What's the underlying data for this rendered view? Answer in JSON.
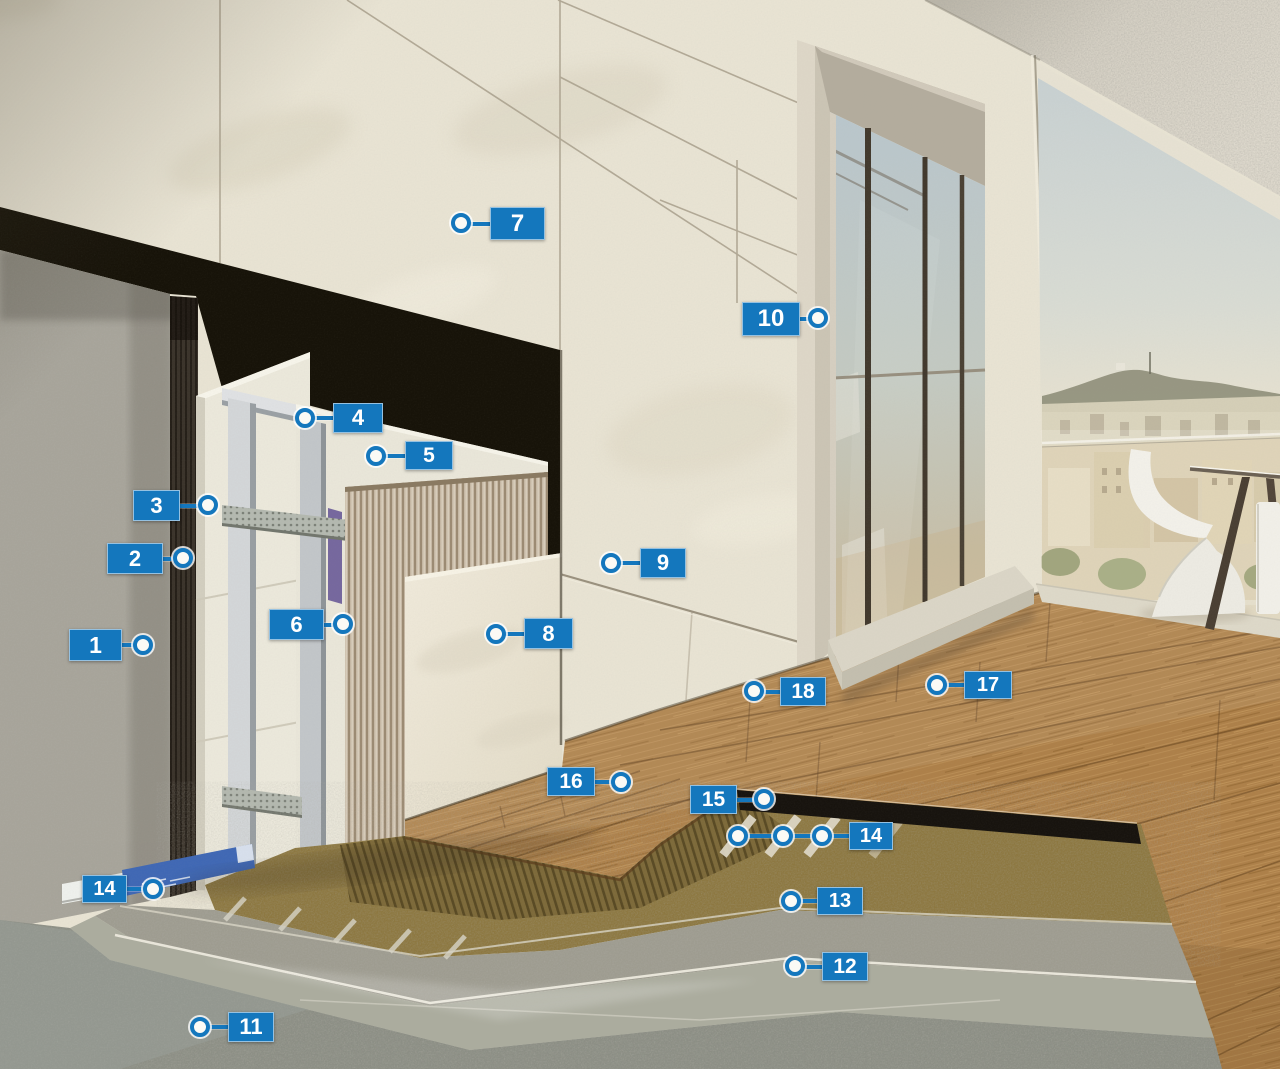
{
  "figure": {
    "type": "construction-cutaway-callout-diagram",
    "accent_color": "#1477bd",
    "marker_text_color": "#ffffff"
  },
  "markers": [
    {
      "id": "m1",
      "label": "1",
      "box": {
        "x": 69,
        "y": 629,
        "w": 53,
        "h": 32
      },
      "side": "right",
      "dots": [
        {
          "x": 143,
          "y": 645
        }
      ]
    },
    {
      "id": "m2",
      "label": "2",
      "box": {
        "x": 107,
        "y": 543,
        "w": 56,
        "h": 31
      },
      "side": "right",
      "dots": [
        {
          "x": 183,
          "y": 558
        }
      ]
    },
    {
      "id": "m3",
      "label": "3",
      "box": {
        "x": 133,
        "y": 490,
        "w": 47,
        "h": 31
      },
      "side": "right",
      "dots": [
        {
          "x": 208,
          "y": 505
        }
      ]
    },
    {
      "id": "m4",
      "label": "4",
      "box": {
        "x": 333,
        "y": 403,
        "w": 50,
        "h": 30
      },
      "side": "left",
      "dots": [
        {
          "x": 305,
          "y": 418
        }
      ]
    },
    {
      "id": "m5",
      "label": "5",
      "box": {
        "x": 405,
        "y": 441,
        "w": 48,
        "h": 29
      },
      "side": "left",
      "dots": [
        {
          "x": 376,
          "y": 456
        }
      ]
    },
    {
      "id": "m6",
      "label": "6",
      "box": {
        "x": 269,
        "y": 609,
        "w": 55,
        "h": 31
      },
      "side": "right",
      "dots": [
        {
          "x": 343,
          "y": 624
        }
      ]
    },
    {
      "id": "m7",
      "label": "7",
      "box": {
        "x": 490,
        "y": 207,
        "w": 55,
        "h": 33
      },
      "side": "left",
      "dots": [
        {
          "x": 461,
          "y": 223
        }
      ]
    },
    {
      "id": "m8",
      "label": "8",
      "box": {
        "x": 524,
        "y": 618,
        "w": 49,
        "h": 31
      },
      "side": "left",
      "dots": [
        {
          "x": 496,
          "y": 634
        }
      ]
    },
    {
      "id": "m9",
      "label": "9",
      "box": {
        "x": 640,
        "y": 548,
        "w": 46,
        "h": 30
      },
      "side": "left",
      "dots": [
        {
          "x": 611,
          "y": 563
        }
      ]
    },
    {
      "id": "m10",
      "label": "10",
      "box": {
        "x": 742,
        "y": 302,
        "w": 58,
        "h": 34
      },
      "side": "right",
      "dots": [
        {
          "x": 818,
          "y": 318
        }
      ]
    },
    {
      "id": "m11",
      "label": "11",
      "box": {
        "x": 228,
        "y": 1012,
        "w": 46,
        "h": 30
      },
      "side": "left",
      "dots": [
        {
          "x": 200,
          "y": 1027
        }
      ]
    },
    {
      "id": "m12",
      "label": "12",
      "box": {
        "x": 822,
        "y": 952,
        "w": 46,
        "h": 29
      },
      "side": "left",
      "dots": [
        {
          "x": 795,
          "y": 966
        }
      ]
    },
    {
      "id": "m13",
      "label": "13",
      "box": {
        "x": 817,
        "y": 887,
        "w": 46,
        "h": 28
      },
      "side": "left",
      "dots": [
        {
          "x": 791,
          "y": 901
        }
      ]
    },
    {
      "id": "m14a",
      "label": "14",
      "box": {
        "x": 82,
        "y": 875,
        "w": 45,
        "h": 28
      },
      "side": "right",
      "dots": [
        {
          "x": 153,
          "y": 889
        }
      ]
    },
    {
      "id": "m14b",
      "label": "14",
      "box": {
        "x": 849,
        "y": 822,
        "w": 44,
        "h": 28
      },
      "side": "left",
      "dots": [
        {
          "x": 738,
          "y": 836
        },
        {
          "x": 783,
          "y": 836
        },
        {
          "x": 822,
          "y": 836
        }
      ]
    },
    {
      "id": "m15",
      "label": "15",
      "box": {
        "x": 690,
        "y": 785,
        "w": 47,
        "h": 29
      },
      "side": "right",
      "dots": [
        {
          "x": 764,
          "y": 799
        }
      ]
    },
    {
      "id": "m16",
      "label": "16",
      "box": {
        "x": 547,
        "y": 767,
        "w": 48,
        "h": 29
      },
      "side": "right",
      "dots": [
        {
          "x": 621,
          "y": 782
        }
      ]
    },
    {
      "id": "m17",
      "label": "17",
      "box": {
        "x": 964,
        "y": 671,
        "w": 48,
        "h": 28
      },
      "side": "left",
      "dots": [
        {
          "x": 937,
          "y": 685
        }
      ]
    },
    {
      "id": "m18",
      "label": "18",
      "box": {
        "x": 780,
        "y": 677,
        "w": 46,
        "h": 29
      },
      "side": "left",
      "dots": [
        {
          "x": 754,
          "y": 691
        }
      ]
    }
  ]
}
